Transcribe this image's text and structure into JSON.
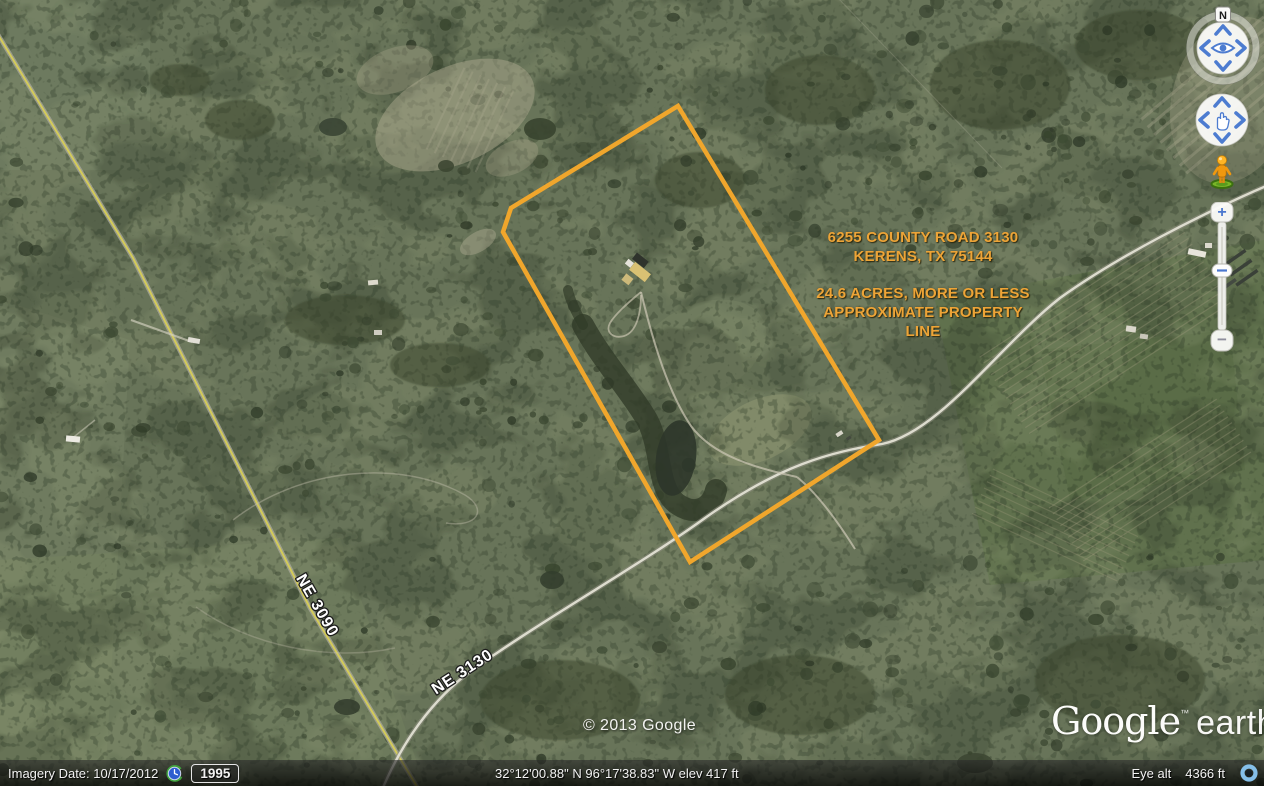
{
  "map": {
    "annotation": {
      "line1": "6255 COUNTY ROAD 3130",
      "line2": "KERENS, TX 75144",
      "line3": "24.6 ACRES, MORE OR LESS",
      "line4": "APPROXIMATE PROPERTY LINE",
      "color": "#EDA437"
    },
    "property_line": {
      "points": "678,106 879,440 690,562 503,232 511,208",
      "color": "#F0A62C"
    },
    "road_labels": [
      {
        "text": "NE 3090"
      },
      {
        "text": "NE 3130"
      }
    ],
    "copyright": "© 2013 Google"
  },
  "logo": {
    "google": "Google",
    "tm": "™",
    "earth": "earth"
  },
  "controls": {
    "compass_north_label": "N",
    "zoom_in_label": "+",
    "zoom_out_label": "−"
  },
  "status_bar": {
    "imagery_date": "Imagery Date: 10/17/2012",
    "history_year": "1995",
    "coordinates": "32°12'00.88\" N   96°17'38.83\" W elev   417 ft",
    "eye_alt_label": "Eye alt",
    "eye_alt_value": "4366 ft"
  }
}
